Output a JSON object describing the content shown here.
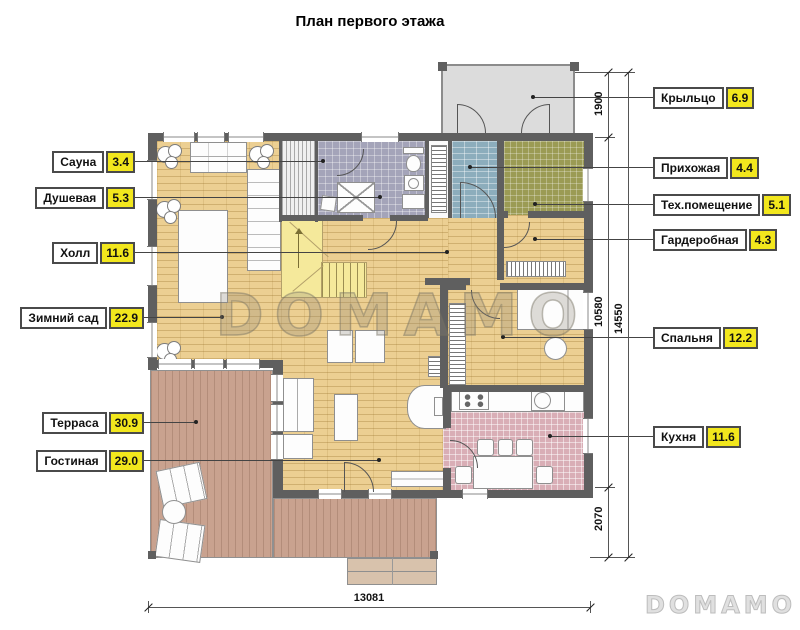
{
  "title": "План первого этажа",
  "labels": {
    "sauna": {
      "name": "Сауна",
      "value": "3.4"
    },
    "shower": {
      "name": "Душевая",
      "value": "5.3"
    },
    "hall": {
      "name": "Холл",
      "value": "11.6"
    },
    "winter_garden": {
      "name": "Зимний сад",
      "value": "22.9"
    },
    "terrace": {
      "name": "Терраса",
      "value": "30.9"
    },
    "living": {
      "name": "Гостиная",
      "value": "29.0"
    },
    "porch": {
      "name": "Крыльцо",
      "value": "6.9"
    },
    "entry": {
      "name": "Прихожая",
      "value": "4.4"
    },
    "tech": {
      "name": "Тех.помещение",
      "value": "5.1"
    },
    "wardrobe": {
      "name": "Гардеробная",
      "value": "4.3"
    },
    "bedroom": {
      "name": "Спальня",
      "value": "12.2"
    },
    "kitchen": {
      "name": "Кухня",
      "value": "11.6"
    }
  },
  "dimensions": {
    "porch_depth": "1900",
    "main_height": "10580",
    "total_height": "14550",
    "terrace_depth": "2070",
    "total_width": "13081"
  },
  "watermark": {
    "center": "DOMAMO",
    "logo": "DOMAMO"
  },
  "colors": {
    "wall": "#5f5f5f",
    "wood_floor": "#eccf92",
    "bath_tile": "#a4a4b9",
    "entry_tile": "#8cadbc",
    "tech_tile": "#9b9b54",
    "kitchen_tile": "#d9aeb6",
    "terrace_deck": "#c9a28f",
    "stairs": "#f5e99b",
    "porch_floor": "#dcdcdc",
    "label_value_bg": "#f2e71d"
  }
}
